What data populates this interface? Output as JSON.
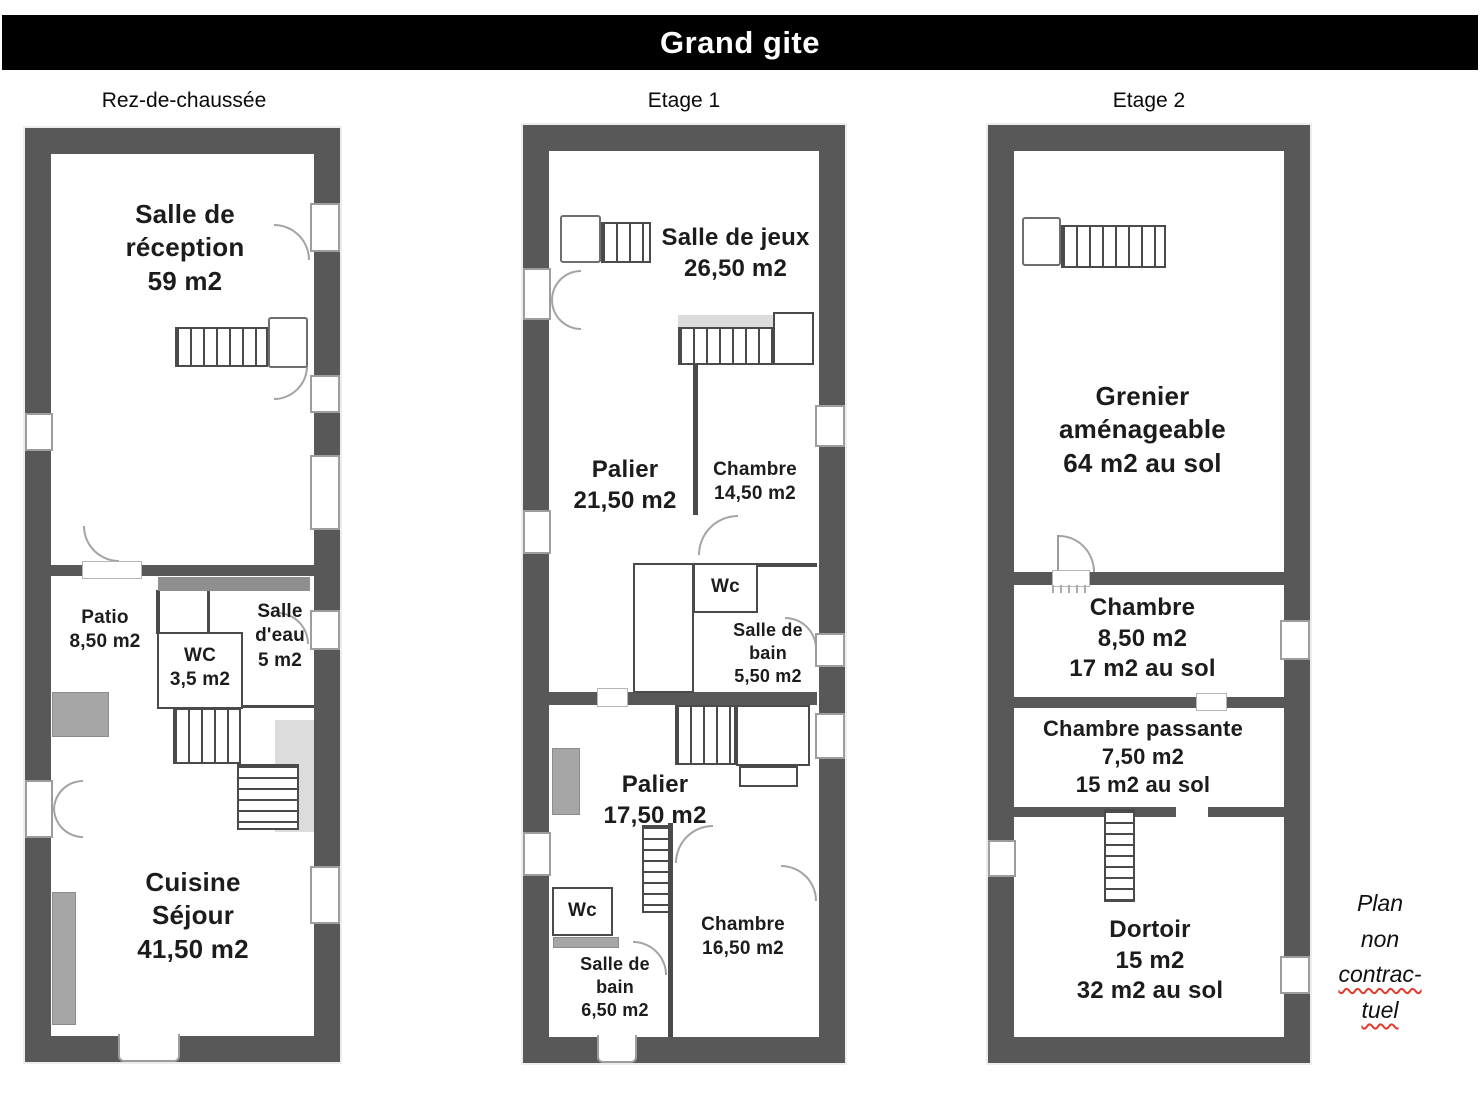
{
  "header": {
    "title": "Grand gite"
  },
  "floors": [
    {
      "label": "Rez-de-chaussée",
      "rooms": {
        "reception": {
          "name": "Salle de réception",
          "area": "59 m2"
        },
        "patio": {
          "name": "Patio",
          "area": "8,50 m2"
        },
        "wc": {
          "name": "WC",
          "area": "3,5 m2"
        },
        "salle_eau": {
          "name": "Salle d'eau",
          "area": "5 m2"
        },
        "cuisine": {
          "name": "Cuisine Séjour",
          "area": "41,50 m2"
        }
      }
    },
    {
      "label": "Etage 1",
      "rooms": {
        "salle_jeux": {
          "name": "Salle de jeux",
          "area": "26,50 m2"
        },
        "palier1": {
          "name": "Palier",
          "area": "21,50 m2"
        },
        "chambre1": {
          "name": "Chambre",
          "area": "14,50 m2"
        },
        "wc_haut": {
          "name": "Wc"
        },
        "sdb1": {
          "name": "Salle de bain",
          "area": "5,50 m2"
        },
        "palier2": {
          "name": "Palier",
          "area": "17,50 m2"
        },
        "wc_bas": {
          "name": "Wc"
        },
        "sdb2": {
          "name": "Salle de bain",
          "area": "6,50 m2"
        },
        "chambre2": {
          "name": "Chambre",
          "area": "16,50 m2"
        }
      }
    },
    {
      "label": "Etage 2",
      "rooms": {
        "grenier": {
          "name": "Grenier aménageable",
          "area": "64 m2 au sol"
        },
        "chambre850": {
          "name": "Chambre",
          "area": "8,50 m2",
          "area2": "17 m2 au sol"
        },
        "chambre_passante": {
          "name": "Chambre passante",
          "area": "7,50 m2",
          "area2": "15 m2 au sol"
        },
        "dortoir": {
          "name": "Dortoir",
          "area": "15 m2",
          "area2": "32 m2 au sol"
        }
      }
    }
  ],
  "note": {
    "line1": "Plan",
    "line2": "non",
    "line3": "contrac-",
    "line4": "tuel"
  },
  "colors": {
    "wall": "#585858",
    "header_bg": "#000000",
    "note_underline": "#e23b2e"
  }
}
